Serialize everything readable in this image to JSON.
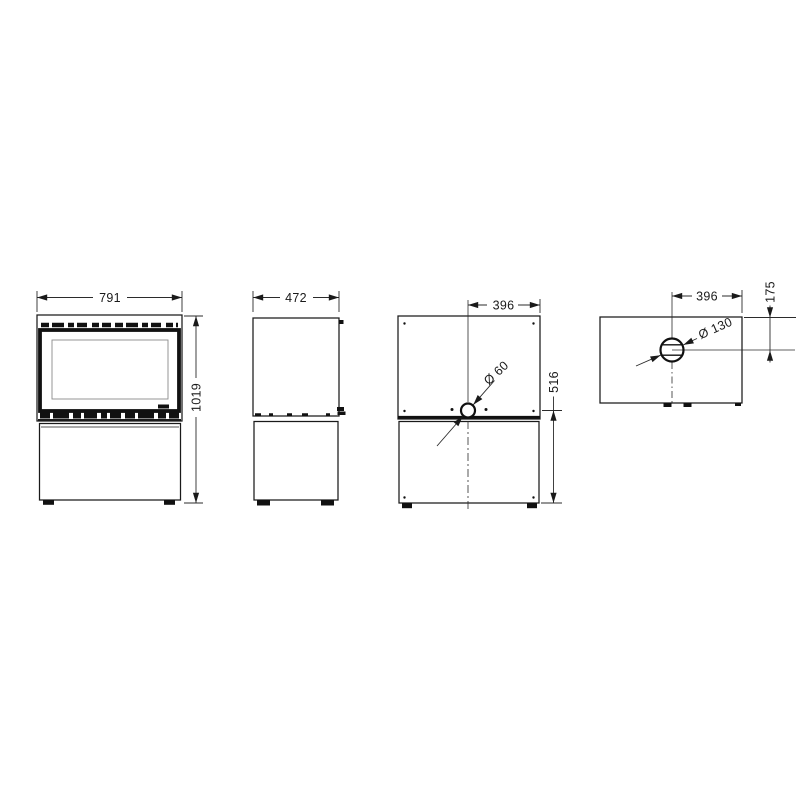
{
  "document": {
    "kind": "technical-dimension-drawing",
    "subject": "freestanding stove with base cabinet, four orthographic views",
    "background_color": "#ffffff",
    "line_color": "#1a1a1a",
    "dimension_line_color": "#2b2b2b",
    "glass_outline_color": "#8a8a8a"
  },
  "views": {
    "front": {
      "name": "front view",
      "width_label": "791",
      "height_label": "1019"
    },
    "side": {
      "name": "side view",
      "depth_label": "472"
    },
    "rear": {
      "name": "rear view",
      "flue_offset_label": "396",
      "flue_diameter_label": "Ø 60",
      "flue_height_label": "516"
    },
    "top": {
      "name": "top view",
      "flue_offset_label": "396",
      "flue_diameter_label": "Ø 130",
      "flue_depth_label": "175"
    }
  }
}
